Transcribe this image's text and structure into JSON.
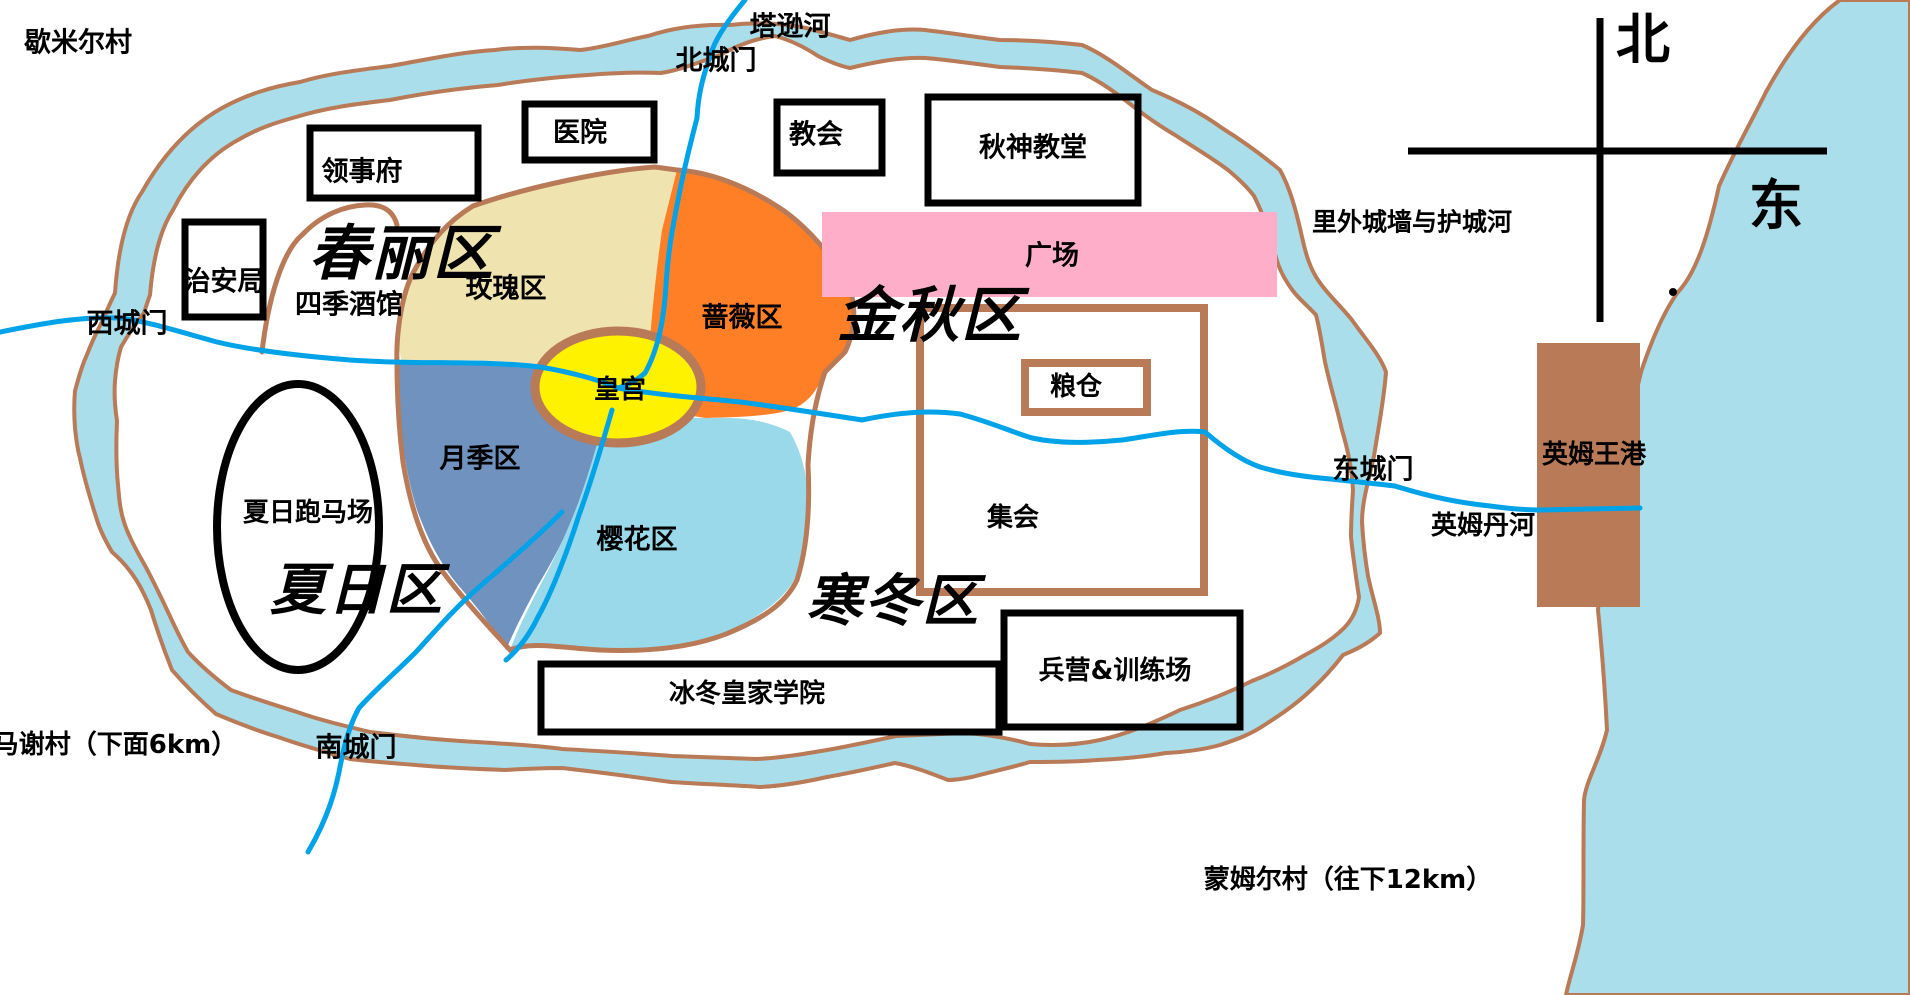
{
  "map_type": "hand-drawn city map",
  "colors": {
    "ink": "#000000",
    "wall_brown": "#B97A57",
    "water_light": "#A9DEEA",
    "river_blue": "#00A2E8",
    "district_beige": "#EFE4B0",
    "district_orange": "#FF7F27",
    "district_bluegray": "#7092BE",
    "district_sakura": "#99D9EA",
    "palace_yellow": "#FFF200",
    "plaza_pink": "#FFAEC9"
  },
  "compass": {
    "north_char": "北",
    "east_char": "东"
  },
  "district_titles": [
    {
      "id": "chunli",
      "text": "春丽区"
    },
    {
      "id": "jinqiu",
      "text": "金秋区"
    },
    {
      "id": "xiari",
      "text": "夏日区"
    },
    {
      "id": "handong",
      "text": "寒冬区"
    }
  ],
  "labels": [
    {
      "id": "xiemier-village",
      "text": "歇米尔村"
    },
    {
      "id": "tasun-river",
      "text": "塔逊河"
    },
    {
      "id": "north-gate",
      "text": "北城门"
    },
    {
      "id": "west-gate",
      "text": "西城门"
    },
    {
      "id": "east-gate",
      "text": "东城门"
    },
    {
      "id": "south-gate",
      "text": "南城门"
    },
    {
      "id": "consulate",
      "text": "领事府"
    },
    {
      "id": "hospital",
      "text": "医院"
    },
    {
      "id": "church",
      "text": "教会"
    },
    {
      "id": "autumn-god-church",
      "text": "秋神教堂"
    },
    {
      "id": "security-bureau",
      "text": "治安局"
    },
    {
      "id": "four-seasons-tavern",
      "text": "四季酒馆"
    },
    {
      "id": "rose-district",
      "text": "玫瑰区"
    },
    {
      "id": "qiangwei-district",
      "text": "蔷薇区"
    },
    {
      "id": "royal-palace",
      "text": "皇宫"
    },
    {
      "id": "yueji-district",
      "text": "月季区"
    },
    {
      "id": "sakura-district",
      "text": "樱花区"
    },
    {
      "id": "granary",
      "text": "粮仓"
    },
    {
      "id": "assembly",
      "text": "集会"
    },
    {
      "id": "plaza",
      "text": "广场"
    },
    {
      "id": "walls-and-moat",
      "text": "里外城墙与护城河"
    },
    {
      "id": "yingmu-king-port",
      "text": "英姆王港"
    },
    {
      "id": "yingmudan-river",
      "text": "英姆丹河"
    },
    {
      "id": "summer-racecourse",
      "text": "夏日跑马场"
    },
    {
      "id": "royal-academy",
      "text": "冰冬皇家学院"
    },
    {
      "id": "barracks",
      "text": "兵营&训练场"
    },
    {
      "id": "maxie-village",
      "text": "马谢村（下面6km）"
    },
    {
      "id": "mengmuer-village",
      "text": "蒙姆尔村（往下12km）"
    },
    {
      "id": "compass-north",
      "text": "北"
    },
    {
      "id": "compass-east",
      "text": "东"
    }
  ]
}
